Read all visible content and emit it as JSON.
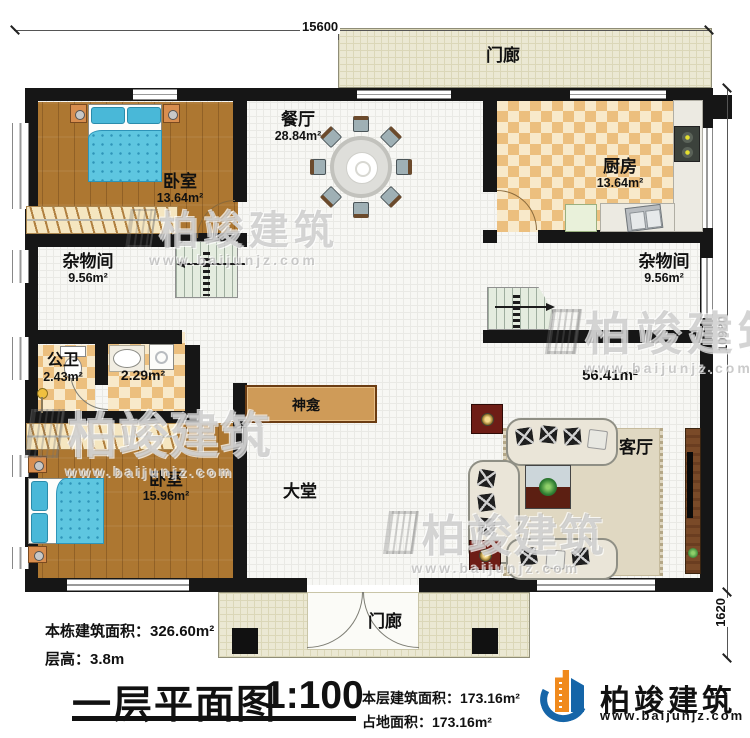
{
  "plan": {
    "title": "一层平面图",
    "scale": "1:100"
  },
  "dimensions": {
    "top_width": "15600",
    "right_height": "10980",
    "porch_depth": "1620"
  },
  "rooms": {
    "bedroom_top": {
      "name": "卧室",
      "area": "13.64m²"
    },
    "dining": {
      "name": "餐厅",
      "area": "28.84m²"
    },
    "kitchen": {
      "name": "厨房",
      "area": "13.64m²"
    },
    "storage_left": {
      "name": "杂物间",
      "area": "9.56m²"
    },
    "storage_right": {
      "name": "杂物间",
      "area": "9.56m²"
    },
    "bathroom": {
      "name": "公卫",
      "area": "2.43m²"
    },
    "laundry": {
      "area": "2.29m²"
    },
    "shrine": {
      "name": "神龛"
    },
    "hall": {
      "name": "大堂"
    },
    "open_area": {
      "area": "56.41m²"
    },
    "living": {
      "name": "客厅"
    },
    "bedroom_bottom": {
      "name": "卧室",
      "area": "15.96m²"
    },
    "porch_top": {
      "name": "门廊"
    },
    "porch_bottom": {
      "name": "门廊"
    }
  },
  "notes": {
    "total_area": "本栋建筑面积：326.60m²",
    "floor_height": "层高：3.8m",
    "floor_area": "本层建筑面积：173.16m²",
    "footprint_area": "占地面积：173.16m²"
  },
  "logo": {
    "brand": "柏竣建筑",
    "site": "www.baijunjz.com"
  },
  "watermark": {
    "brand": "柏竣建筑",
    "site": "www.baijunjz.com"
  },
  "colors": {
    "wall": "#161616",
    "wood_floor": "#ad7731",
    "checker_dark": "#ecbf7e",
    "checker_light": "#f8e9ca",
    "porch": "#ebe8d3",
    "bed_blue": "#5ec6e0",
    "shrine_wood": "#cf9b58",
    "logo_blue": "#1565a8",
    "logo_orange": "#f08a1d"
  }
}
